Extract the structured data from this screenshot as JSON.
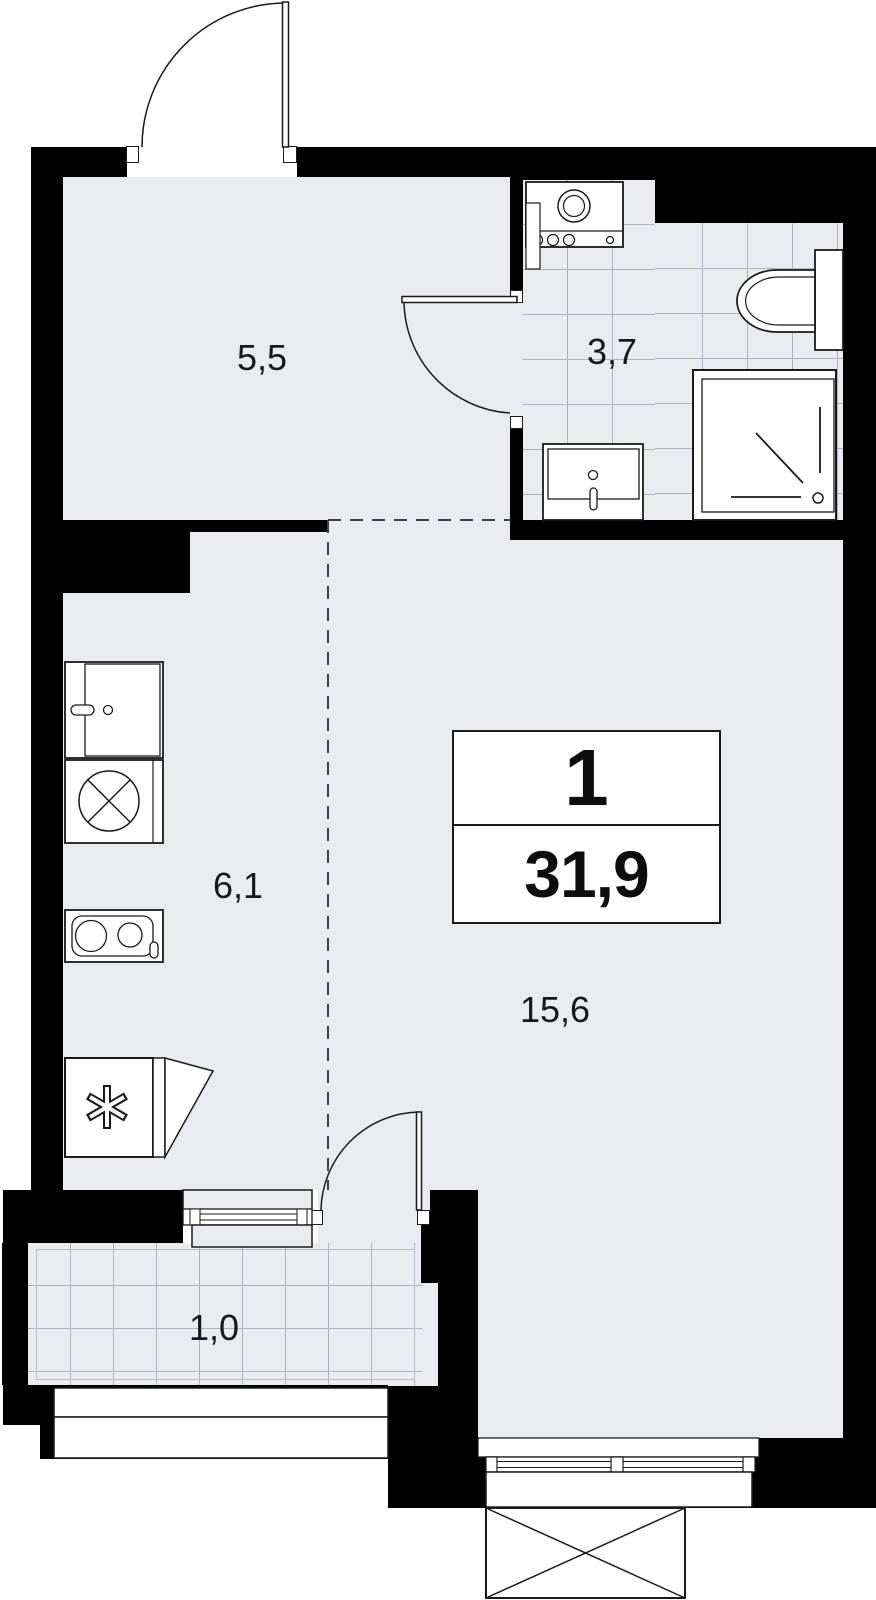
{
  "floorplan": {
    "unit_info": {
      "rooms_count": "1",
      "total_area": "31,9"
    },
    "rooms": {
      "hallway": {
        "area_label": "5,5"
      },
      "bathroom": {
        "area_label": "3,7"
      },
      "kitchen": {
        "area_label": "6,1"
      },
      "living_room": {
        "area_label": "15,6"
      },
      "balcony": {
        "area_label": "1,0"
      }
    },
    "fixtures": [
      "entry-door",
      "bathroom-door",
      "balcony-door",
      "washing-machine",
      "toilet",
      "shower",
      "bathroom-sink",
      "kitchen-sink",
      "stove",
      "burner-hob",
      "fridge",
      "balcony-window",
      "main-window",
      "balcony-railing",
      "exterior-unit"
    ],
    "colors": {
      "wall": "#000000",
      "floor": "#e9ebee",
      "tile_line": "#aeb4bf",
      "outline": "#1a1a1a",
      "dashed_zone_line": "#3f3f46",
      "fixture_fill": "#ffffff",
      "label_text": "#17181c",
      "background": "#ffffff"
    }
  }
}
